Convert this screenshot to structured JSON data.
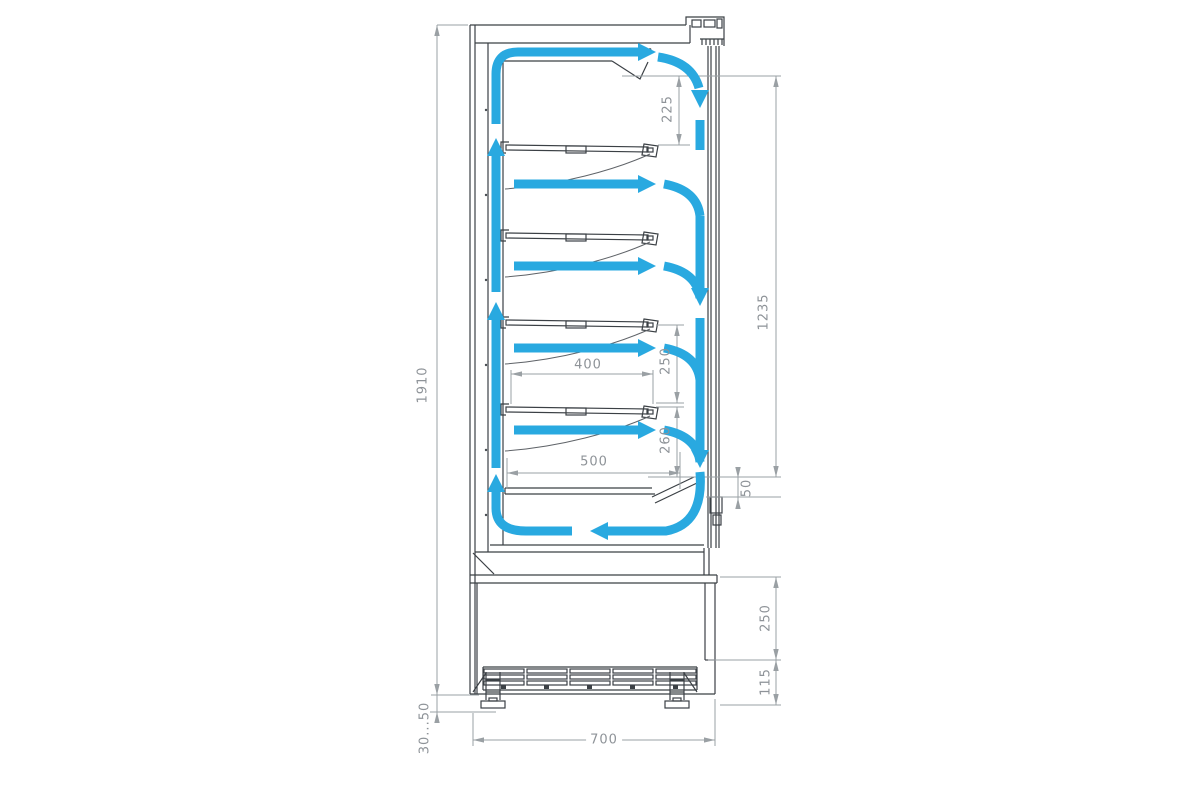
{
  "colors": {
    "airflow_blue": "#29a9e0",
    "outline": "#3b4045",
    "dimension_lines": "#9aa0a4",
    "dimension_text": "#8e9398",
    "background": "#ffffff"
  },
  "dims": {
    "overall_height": "1910",
    "top_air_gap": "225",
    "opening_height": "1235",
    "shelf_gap_upper": "250",
    "shelf_gap_lower": "260",
    "shelf_depth": "400",
    "bottom_deck_depth": "500",
    "air_intake": "50",
    "base_height": "250",
    "grille_height": "115",
    "depth": "700",
    "leg_adjustment": "30...50"
  },
  "airflow": {
    "color": "#29a9e0",
    "arrows": [
      "up-back-duct",
      "across-top-duct",
      "down-air-curtain",
      "over-shelf-1",
      "over-shelf-2",
      "over-shelf-3",
      "over-shelf-4",
      "bottom-return"
    ]
  }
}
